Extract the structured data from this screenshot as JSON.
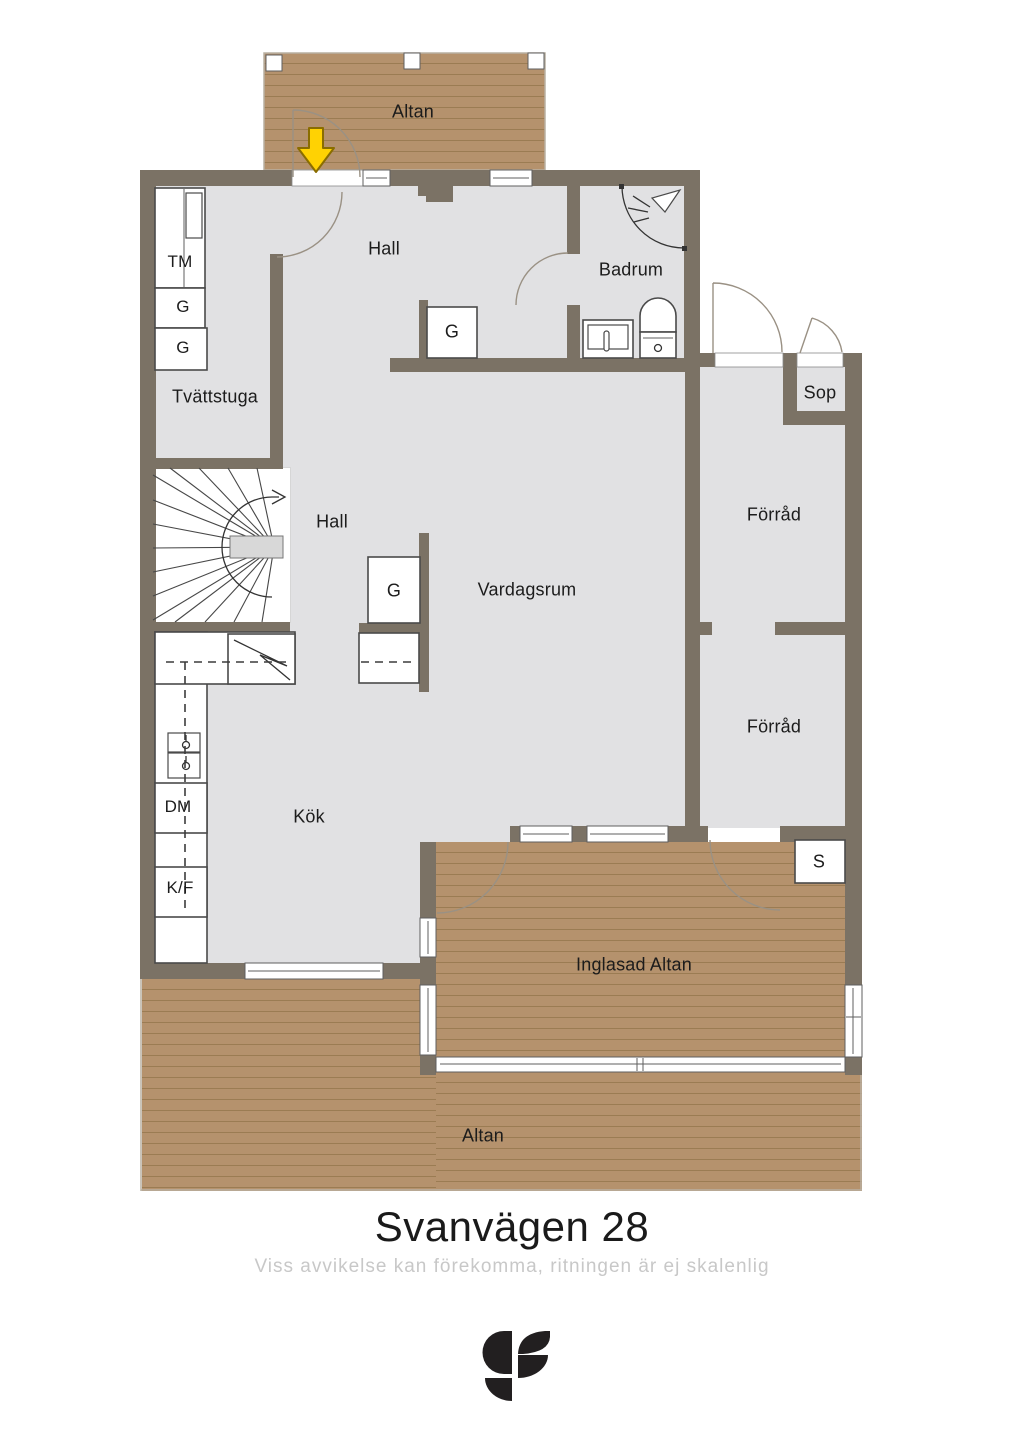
{
  "title": {
    "text": "Svanvägen 28",
    "disclaimer": "Viss avvikelse kan förekomma, ritningen är ej skalenlig"
  },
  "branding": {
    "logo_name": "svensk-fastighetsformedling-sf-monogram"
  },
  "rooms": {
    "altan_top": "Altan",
    "hall_upper": "Hall",
    "badrum": "Badrum",
    "tvattstuga": "Tvättstuga",
    "hall_lower": "Hall",
    "vardagsrum": "Vardagsrum",
    "forrad_upper": "Förråd",
    "forrad_lower": "Förråd",
    "sop": "Sop",
    "kok": "Kök",
    "inglasad_altan": "Inglasad Altan",
    "altan_bottom": "Altan"
  },
  "fixtures": {
    "tm": "TM",
    "g1": "G",
    "g2": "G",
    "g_hall_upper": "G",
    "g_hall_lower": "G",
    "dm": "DM",
    "kf": "K/F",
    "s": "S"
  },
  "icons": {
    "entrance_arrow": "entrance-direction-arrow",
    "stairs_arrow": "stairs-walk-line-arrow",
    "shower": "shower-head"
  },
  "colors": {
    "wall": "#7b7265",
    "floor": "#e1e1e3",
    "wood": "#b5926d",
    "wood_line": "#9b7c53",
    "landing": "#d8d8d8",
    "fixture_outline": "#4a4a4a",
    "arc_color": "#9a9184",
    "arrow_yellow": "#ffd203",
    "arrow_outline": "#8a6d00",
    "title_color": "#1a1a1a",
    "disclaimer_color": "#c8c8c8",
    "logo_color": "#221f20"
  }
}
